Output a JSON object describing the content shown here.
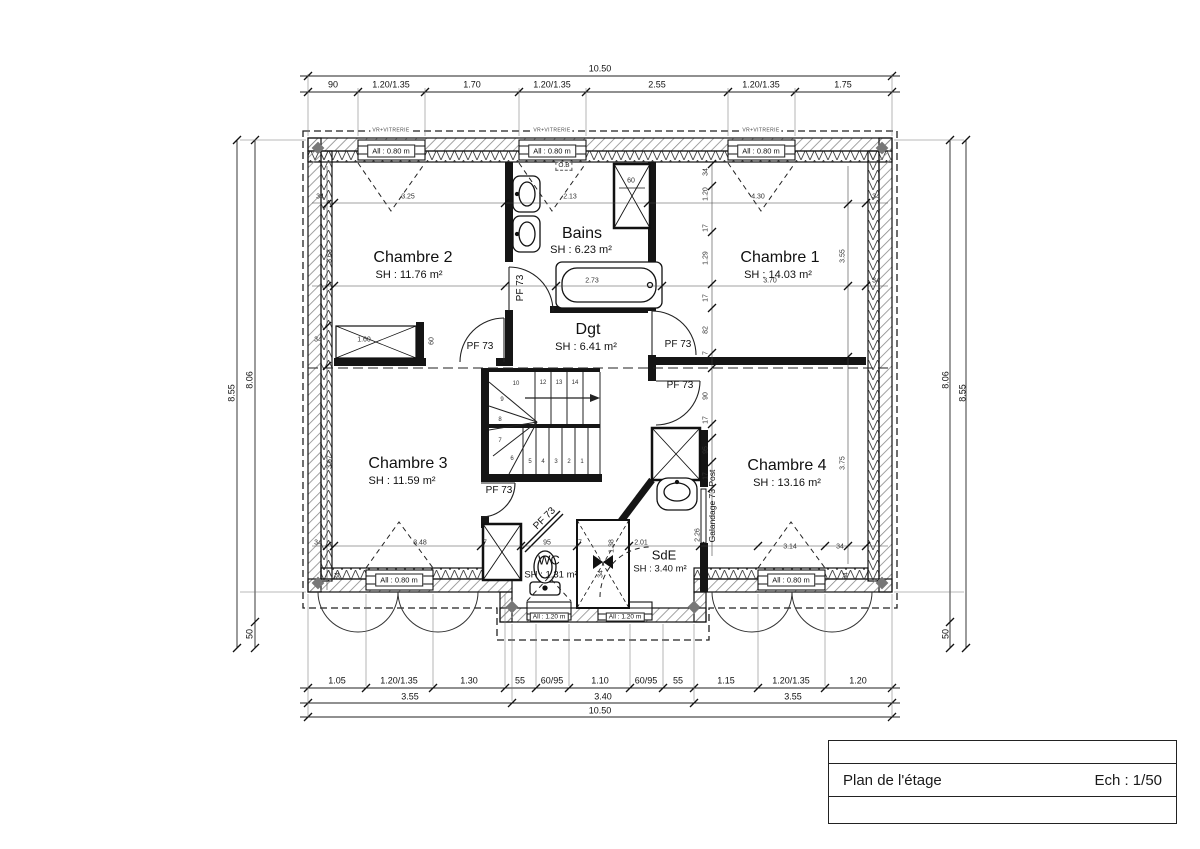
{
  "title_block": {
    "plan_label": "Plan de l'étage",
    "scale_label": "Ech : 1/50"
  },
  "rooms": [
    {
      "name": "Chambre 2",
      "area": "SH : 11.76 m²",
      "x": 413,
      "y": 258,
      "ax": 409,
      "ay": 275
    },
    {
      "name": "Bains",
      "area": "SH : 6.23 m²",
      "x": 582,
      "y": 234,
      "ax": 581,
      "ay": 250
    },
    {
      "name": "Chambre 1",
      "area": "SH : 14.03 m²",
      "x": 780,
      "y": 258,
      "ax": 778,
      "ay": 275
    },
    {
      "name": "Dgt",
      "area": "SH : 6.41 m²",
      "x": 588,
      "y": 330,
      "ax": 586,
      "ay": 347
    },
    {
      "name": "Chambre 3",
      "area": "SH : 11.59 m²",
      "x": 408,
      "y": 464,
      "ax": 402,
      "ay": 481
    },
    {
      "name": "Chambre 4",
      "area": "SH : 13.16 m²",
      "x": 787,
      "y": 466,
      "ax": 787,
      "ay": 483
    },
    {
      "name": "WC",
      "area": "SH : 1.31 m²",
      "x": 549,
      "y": 560,
      "ax": 551,
      "ay": 575,
      "small": true
    },
    {
      "name": "SdE",
      "area": "SH : 3.40 m²",
      "x": 664,
      "y": 555,
      "ax": 660,
      "ay": 569,
      "small": true
    }
  ],
  "windows": [
    {
      "label": "All : 0.80 m",
      "x": 391,
      "y": 151
    },
    {
      "label": "All : 0.80 m",
      "x": 552,
      "y": 151
    },
    {
      "label": "All : 0.80 m",
      "x": 761,
      "y": 151
    },
    {
      "label": "All : 0.80 m",
      "x": 399,
      "y": 580
    },
    {
      "label": "All : 0.80 m",
      "x": 791,
      "y": 580
    },
    {
      "label": "All : 1.20 m",
      "x": 549,
      "y": 617,
      "small": true
    },
    {
      "label": "All : 1.20 m",
      "x": 625,
      "y": 617,
      "small": true
    }
  ],
  "annotations": [
    {
      "t": "10.50",
      "x": 600,
      "y": 69,
      "c": "d"
    },
    {
      "t": "90",
      "x": 333,
      "y": 85,
      "c": "d"
    },
    {
      "t": "1.20/1.35",
      "x": 391,
      "y": 85,
      "c": "d"
    },
    {
      "t": "1.70",
      "x": 472,
      "y": 85,
      "c": "d"
    },
    {
      "t": "1.20/1.35",
      "x": 552,
      "y": 85,
      "c": "d"
    },
    {
      "t": "2.55",
      "x": 657,
      "y": 85,
      "c": "d"
    },
    {
      "t": "1.20/1.35",
      "x": 761,
      "y": 85,
      "c": "d"
    },
    {
      "t": "1.75",
      "x": 843,
      "y": 85,
      "c": "d"
    },
    {
      "t": "1.05",
      "x": 337,
      "y": 681,
      "c": "d"
    },
    {
      "t": "1.20/1.35",
      "x": 399,
      "y": 681,
      "c": "d"
    },
    {
      "t": "1.30",
      "x": 469,
      "y": 681,
      "c": "d"
    },
    {
      "t": "55",
      "x": 520,
      "y": 681,
      "c": "d"
    },
    {
      "t": "60/95",
      "x": 552,
      "y": 681,
      "c": "d"
    },
    {
      "t": "1.10",
      "x": 600,
      "y": 681,
      "c": "d"
    },
    {
      "t": "60/95",
      "x": 646,
      "y": 681,
      "c": "d"
    },
    {
      "t": "55",
      "x": 678,
      "y": 681,
      "c": "d"
    },
    {
      "t": "1.15",
      "x": 726,
      "y": 681,
      "c": "d"
    },
    {
      "t": "1.20/1.35",
      "x": 791,
      "y": 681,
      "c": "d"
    },
    {
      "t": "1.20",
      "x": 858,
      "y": 681,
      "c": "d"
    },
    {
      "t": "3.55",
      "x": 410,
      "y": 697,
      "c": "d"
    },
    {
      "t": "3.40",
      "x": 603,
      "y": 697,
      "c": "d"
    },
    {
      "t": "3.55",
      "x": 793,
      "y": 697,
      "c": "d"
    },
    {
      "t": "10.50",
      "x": 600,
      "y": 711,
      "c": "d"
    },
    {
      "t": "8.55",
      "x": 232,
      "y": 393,
      "r": -90,
      "c": "d"
    },
    {
      "t": "8.06",
      "x": 250,
      "y": 380,
      "r": -90,
      "c": "d"
    },
    {
      "t": "50",
      "x": 250,
      "y": 634,
      "r": -90,
      "c": "d"
    },
    {
      "t": "8.06",
      "x": 946,
      "y": 380,
      "r": -90,
      "c": "d"
    },
    {
      "t": "8.55",
      "x": 963,
      "y": 393,
      "r": -90,
      "c": "d"
    },
    {
      "t": "50",
      "x": 946,
      "y": 634,
      "r": -90,
      "c": "d"
    },
    {
      "t": "34",
      "x": 320,
      "y": 197,
      "c": "sm"
    },
    {
      "t": "3.25",
      "x": 408,
      "y": 197,
      "c": "sm"
    },
    {
      "t": "2.13",
      "x": 570,
      "y": 197,
      "c": "sm"
    },
    {
      "t": "4.30",
      "x": 758,
      "y": 197,
      "c": "sm"
    },
    {
      "t": "34",
      "x": 876,
      "y": 197,
      "c": "sm"
    },
    {
      "t": "60",
      "x": 631,
      "y": 181,
      "c": "sm"
    },
    {
      "t": "3.63",
      "x": 330,
      "y": 256,
      "r": -90,
      "c": "sm"
    },
    {
      "t": "3.55",
      "x": 843,
      "y": 256,
      "r": -90,
      "c": "sm"
    },
    {
      "t": "3.70",
      "x": 770,
      "y": 281,
      "c": "sm"
    },
    {
      "t": "34",
      "x": 876,
      "y": 281,
      "c": "sm"
    },
    {
      "t": "2.73",
      "x": 592,
      "y": 281,
      "c": "sm"
    },
    {
      "t": "34",
      "x": 706,
      "y": 172,
      "r": -90,
      "c": "sm"
    },
    {
      "t": "1.20",
      "x": 706,
      "y": 194,
      "r": -90,
      "c": "sm"
    },
    {
      "t": "17",
      "x": 706,
      "y": 228,
      "r": -90,
      "c": "sm"
    },
    {
      "t": "1.29",
      "x": 706,
      "y": 258,
      "r": -90,
      "c": "sm"
    },
    {
      "t": "17",
      "x": 706,
      "y": 298,
      "r": -90,
      "c": "sm"
    },
    {
      "t": "82",
      "x": 706,
      "y": 330,
      "r": -90,
      "c": "sm"
    },
    {
      "t": "7",
      "x": 706,
      "y": 353,
      "r": -90,
      "c": "sm"
    },
    {
      "t": "90",
      "x": 706,
      "y": 396,
      "r": -90,
      "c": "sm"
    },
    {
      "t": "17",
      "x": 706,
      "y": 420,
      "r": -90,
      "c": "sm"
    },
    {
      "t": "95",
      "x": 706,
      "y": 450,
      "r": -90,
      "c": "sm"
    },
    {
      "t": "17",
      "x": 706,
      "y": 476,
      "r": -90,
      "c": "sm"
    },
    {
      "t": "2.26",
      "x": 698,
      "y": 535,
      "r": -90,
      "c": "sm"
    },
    {
      "t": "34",
      "x": 318,
      "y": 340,
      "c": "sm"
    },
    {
      "t": "1.60",
      "x": 364,
      "y": 340,
      "c": "sm"
    },
    {
      "t": "60",
      "x": 432,
      "y": 341,
      "r": -90,
      "c": "sm"
    },
    {
      "t": "3.67",
      "x": 330,
      "y": 462,
      "r": -90,
      "c": "sm"
    },
    {
      "t": "3.75",
      "x": 843,
      "y": 463,
      "r": -90,
      "c": "sm"
    },
    {
      "t": "34",
      "x": 318,
      "y": 543,
      "c": "sm"
    },
    {
      "t": "3.48",
      "x": 420,
      "y": 543,
      "c": "sm"
    },
    {
      "t": "7",
      "x": 485,
      "y": 543,
      "c": "sm"
    },
    {
      "t": "95",
      "x": 547,
      "y": 543,
      "c": "sm"
    },
    {
      "t": "7",
      "x": 580,
      "y": 543,
      "c": "sm"
    },
    {
      "t": "2.01",
      "x": 641,
      "y": 543,
      "c": "sm"
    },
    {
      "t": "1.38",
      "x": 612,
      "y": 546,
      "r": -90,
      "c": "sm"
    },
    {
      "t": "34",
      "x": 601,
      "y": 574,
      "r": -90,
      "c": "sm"
    },
    {
      "t": "3.14",
      "x": 790,
      "y": 547,
      "c": "sm"
    },
    {
      "t": "34",
      "x": 840,
      "y": 547,
      "c": "sm"
    },
    {
      "t": "34",
      "x": 338,
      "y": 576,
      "r": -90,
      "c": "sm"
    },
    {
      "t": "34",
      "x": 846,
      "y": 576,
      "r": -90,
      "c": "sm"
    },
    {
      "t": "14",
      "x": 575,
      "y": 383,
      "c": "xs"
    },
    {
      "t": "13",
      "x": 559,
      "y": 383,
      "c": "xs"
    },
    {
      "t": "12",
      "x": 543,
      "y": 383,
      "c": "xs"
    },
    {
      "t": "10",
      "x": 516,
      "y": 384,
      "c": "xs"
    },
    {
      "t": "9",
      "x": 502,
      "y": 400,
      "c": "xs"
    },
    {
      "t": "8",
      "x": 500,
      "y": 420,
      "c": "xs"
    },
    {
      "t": "7",
      "x": 500,
      "y": 441,
      "c": "xs"
    },
    {
      "t": "6",
      "x": 512,
      "y": 459,
      "c": "xs"
    },
    {
      "t": "5",
      "x": 530,
      "y": 462,
      "c": "xs"
    },
    {
      "t": "4",
      "x": 543,
      "y": 462,
      "c": "xs"
    },
    {
      "t": "3",
      "x": 556,
      "y": 462,
      "c": "xs"
    },
    {
      "t": "2",
      "x": 569,
      "y": 462,
      "c": "xs"
    },
    {
      "t": "1",
      "x": 582,
      "y": 462,
      "c": "xs"
    },
    {
      "t": "PF 73",
      "x": 480,
      "y": 347,
      "c": "pf",
      "n": "door-label"
    },
    {
      "t": "PF 73",
      "x": 678,
      "y": 345,
      "c": "pf",
      "n": "door-label"
    },
    {
      "t": "PF 73",
      "x": 680,
      "y": 386,
      "c": "pf",
      "n": "door-label"
    },
    {
      "t": "PF 73",
      "x": 499,
      "y": 491,
      "c": "pf",
      "n": "door-label"
    },
    {
      "t": "PF 73",
      "x": 521,
      "y": 288,
      "r": -90,
      "c": "pf",
      "n": "door-label"
    },
    {
      "t": "PF 73",
      "x": 545,
      "y": 519,
      "r": -45,
      "c": "pf",
      "n": "door-label"
    },
    {
      "t": "Galandage 73 Post",
      "x": 712,
      "y": 506,
      "r": -90,
      "c": "g",
      "n": "pocket-door-label"
    },
    {
      "t": "O.B",
      "x": 564,
      "y": 166,
      "c": "ob"
    },
    {
      "t": "VR+VITRERIE",
      "x": 391,
      "y": 131,
      "c": "vr",
      "n": "shutter-label"
    },
    {
      "t": "VR+VITRERIE",
      "x": 552,
      "y": 131,
      "c": "vr",
      "n": "shutter-label"
    },
    {
      "t": "VR+VITRERIE",
      "x": 761,
      "y": 131,
      "c": "vr",
      "n": "shutter-label"
    }
  ],
  "dim_hlines": [
    {
      "y": 76,
      "x1": 300,
      "x2": 900,
      "ticks": [
        308,
        892
      ]
    },
    {
      "y": 92,
      "x1": 300,
      "x2": 900,
      "ticks": [
        308,
        358,
        425,
        519,
        586,
        728,
        795,
        892
      ]
    },
    {
      "y": 688,
      "x1": 300,
      "x2": 900,
      "ticks": [
        308,
        366,
        433,
        505,
        536,
        569,
        630,
        663,
        694,
        758,
        825,
        892
      ]
    },
    {
      "y": 703,
      "x1": 300,
      "x2": 900,
      "ticks": [
        308,
        512,
        694,
        892
      ]
    },
    {
      "y": 717,
      "x1": 300,
      "x2": 900,
      "ticks": [
        308,
        892
      ]
    },
    {
      "y": 203,
      "x1": 312,
      "x2": 888,
      "light": true,
      "ticks": [
        334,
        505,
        648,
        866
      ]
    },
    {
      "y": 286,
      "x1": 312,
      "x2": 888,
      "light": true,
      "ticks": [
        334,
        505,
        556,
        662,
        866
      ]
    },
    {
      "y": 546,
      "x1": 312,
      "x2": 888,
      "light": true,
      "ticks": [
        334,
        481,
        521,
        577,
        629,
        700,
        758,
        825,
        866
      ]
    }
  ],
  "dim_vlines": [
    {
      "x": 237,
      "y1": 140,
      "y2": 648,
      "ticks": [
        140,
        648
      ]
    },
    {
      "x": 255,
      "y1": 140,
      "y2": 648,
      "ticks": [
        140,
        622,
        648
      ]
    },
    {
      "x": 950,
      "y1": 140,
      "y2": 648,
      "ticks": [
        140,
        622,
        648
      ]
    },
    {
      "x": 966,
      "y1": 140,
      "y2": 648,
      "ticks": [
        140,
        648
      ]
    },
    {
      "x": 327,
      "y1": 166,
      "y2": 590,
      "light": true,
      "ticks": [
        204,
        286,
        326,
        366,
        546
      ]
    },
    {
      "x": 712,
      "y1": 164,
      "y2": 556,
      "light": true,
      "ticks": [
        164,
        186,
        232,
        284,
        308,
        353,
        368,
        424,
        438,
        462,
        488
      ]
    },
    {
      "x": 848,
      "y1": 166,
      "y2": 564,
      "light": true,
      "ticks": [
        204,
        286,
        357,
        546
      ]
    }
  ],
  "ext_lines": [
    [
      308,
      74,
      308,
      136
    ],
    [
      892,
      74,
      892,
      136
    ],
    [
      358,
      88,
      358,
      136
    ],
    [
      425,
      88,
      425,
      136
    ],
    [
      519,
      88,
      519,
      136
    ],
    [
      586,
      88,
      586,
      136
    ],
    [
      728,
      88,
      728,
      136
    ],
    [
      795,
      88,
      795,
      136
    ],
    [
      308,
      594,
      308,
      717
    ],
    [
      892,
      594,
      892,
      717
    ],
    [
      366,
      594,
      366,
      686
    ],
    [
      433,
      594,
      433,
      686
    ],
    [
      505,
      594,
      505,
      686
    ],
    [
      536,
      624,
      536,
      686
    ],
    [
      569,
      624,
      569,
      686
    ],
    [
      630,
      624,
      630,
      686
    ],
    [
      663,
      624,
      663,
      686
    ],
    [
      512,
      624,
      512,
      701
    ],
    [
      694,
      624,
      694,
      701
    ],
    [
      758,
      594,
      758,
      686
    ],
    [
      825,
      594,
      825,
      686
    ],
    [
      240,
      140,
      306,
      140
    ],
    [
      240,
      592,
      306,
      592
    ],
    [
      894,
      140,
      964,
      140
    ],
    [
      894,
      592,
      964,
      592
    ]
  ]
}
